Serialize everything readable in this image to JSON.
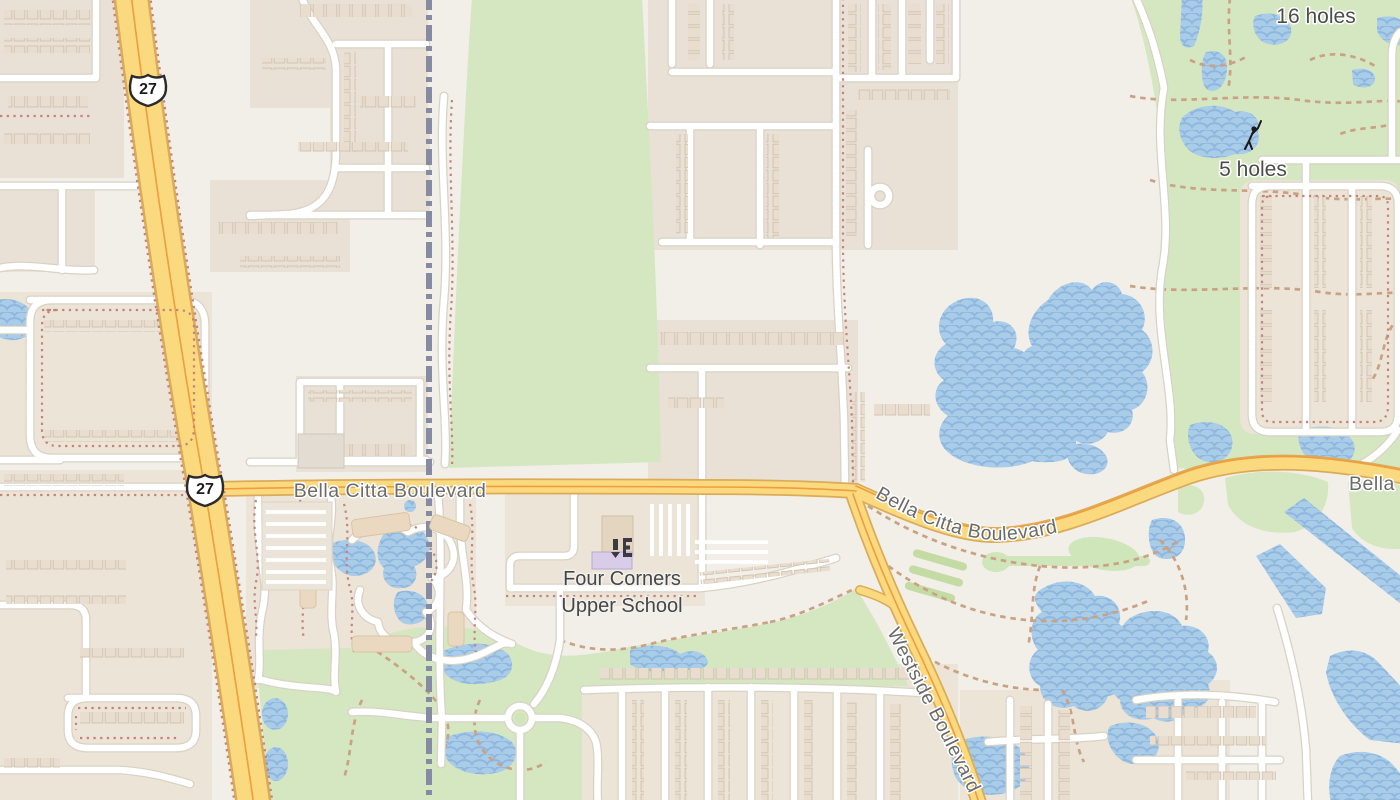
{
  "map": {
    "description": "street map view",
    "road_labels": {
      "bella_citta_west": "Bella Citta Boulevard",
      "bella_citta_east": "Bella Citta Boulevard",
      "bella_citta_partial": "Bella",
      "westside": "Westside Boulevard"
    },
    "route_shields": {
      "us27": "27"
    },
    "place_labels": {
      "holes_16": "16 holes",
      "holes_5": "5 holes",
      "school_line1": "Four Corners",
      "school_line2": "Upper School"
    },
    "icons": {
      "golfer": "golfer-icon",
      "school": "school-icon",
      "us_route_shield": "us-route-shield-icon"
    },
    "colors": {
      "land": "#f2efe9",
      "residential": "#e9e1d6",
      "grass": "#d5e7c1",
      "water": "#a9cce9",
      "water_wave": "#8fb7dd",
      "highway_fill": "#fbd97f",
      "highway_casing": "#dcab57",
      "highway_centerline": "#ef9d3e",
      "road_fill": "#ffffff",
      "road_casing": "#d8d2c5",
      "railway": "#868ba4",
      "fence_dots": "#c5837a",
      "golf_path_dashes": "#c9a284",
      "road_label": "#6b6b6b",
      "place_label": "#4c4c4c",
      "school_building": "#d9cce9"
    }
  }
}
